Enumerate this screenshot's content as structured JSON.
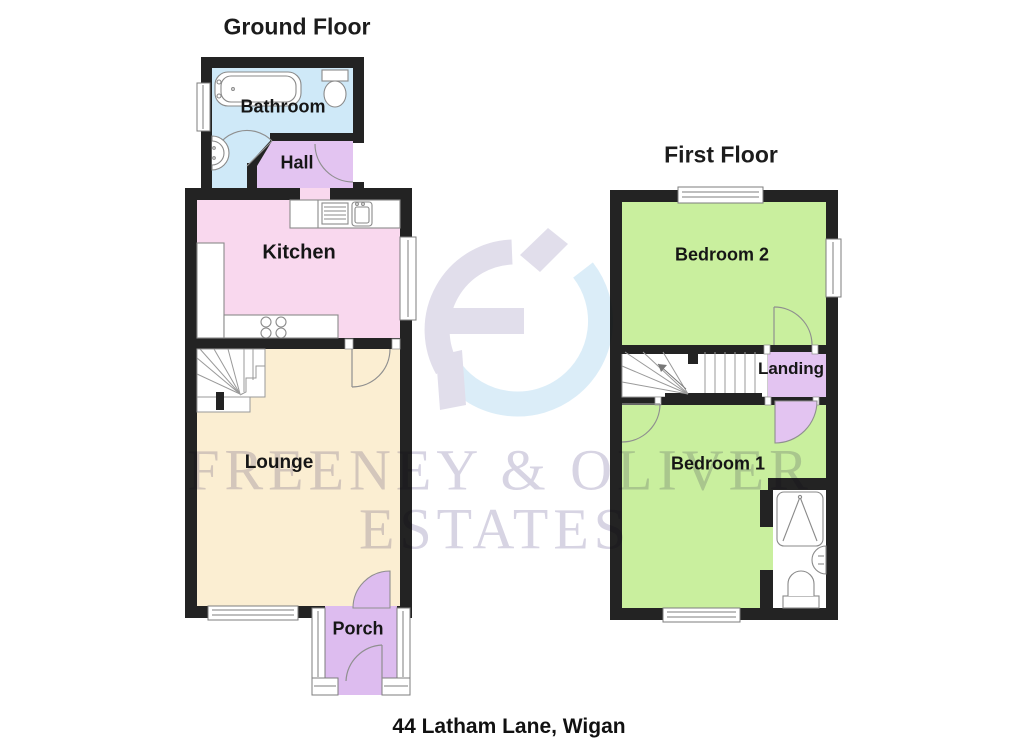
{
  "page": {
    "background": "#ffffff",
    "address": "44 Latham Lane, Wigan"
  },
  "watermark": {
    "line1": "FREENEY & OLIVER",
    "line2": "ESTATES",
    "logo": "freeney-oliver-monogram"
  },
  "floors": {
    "ground": {
      "title": "Ground Floor",
      "rooms": {
        "bathroom": "Bathroom",
        "hall": "Hall",
        "kitchen": "Kitchen",
        "lounge": "Lounge",
        "porch": "Porch"
      }
    },
    "first": {
      "title": "First Floor",
      "rooms": {
        "bedroom2": "Bedroom 2",
        "landing": "Landing",
        "bedroom1": "Bedroom 1"
      }
    }
  },
  "colors": {
    "bathroom": "#cfe9f8",
    "hall": "#e3c4f1",
    "kitchen": "#f9d8ee",
    "lounge": "#fbeed2",
    "porch": "#ddbcef",
    "bedroom": "#c9ef9e",
    "landing": "#e3c4f1",
    "wall": "#232323",
    "watermark": "#d7d4e3"
  }
}
